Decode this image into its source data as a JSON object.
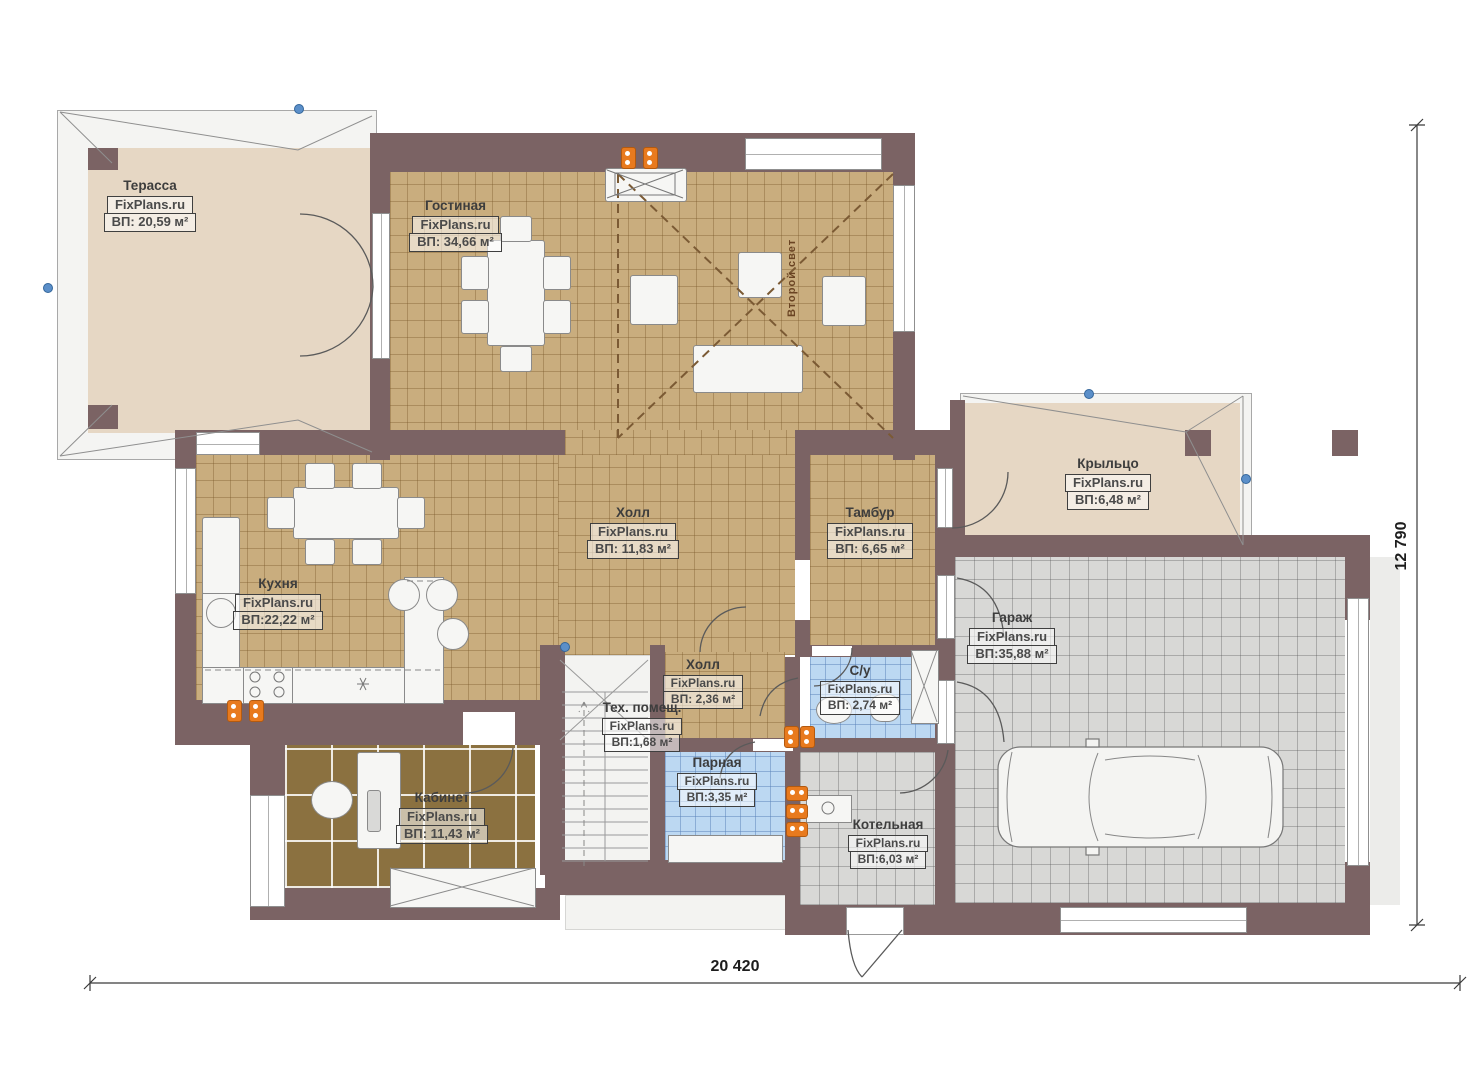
{
  "plan": {
    "watermark": "FixPlans.ru",
    "rooms": {
      "terrace": {
        "name": "Терасса",
        "area": "ВП: 20,59 м²"
      },
      "living": {
        "name": "Гостиная",
        "area": "ВП: 34,66 м²"
      },
      "kitchen": {
        "name": "Кухня",
        "area": "ВП:22,22 м²"
      },
      "hall": {
        "name": "Холл",
        "area": "ВП: 11,83 м²"
      },
      "tambour": {
        "name": "Тамбур",
        "area": "ВП: 6,65 м²"
      },
      "porch": {
        "name": "Крыльцо",
        "area": "ВП:6,48 м²"
      },
      "garage": {
        "name": "Гараж",
        "area": "ВП:35,88 м²"
      },
      "hall2": {
        "name": "Холл",
        "area": "ВП: 2,36 м²"
      },
      "wc": {
        "name": "С/у",
        "area": "ВП: 2,74 м²"
      },
      "tech": {
        "name": "Тех. помещ.",
        "area": "ВП:1,68 м²"
      },
      "steam": {
        "name": "Парная",
        "area": "ВП:3,35 м²"
      },
      "office": {
        "name": "Кабинет",
        "area": "ВП: 11,43 м²"
      },
      "boiler": {
        "name": "Котельная",
        "area": "ВП:6,03 м²"
      }
    },
    "annotations": {
      "second_light": "Второй свет"
    },
    "dimensions": {
      "width": "20 420",
      "height": "12 790"
    },
    "colors": {
      "wall": "#7b6364",
      "tile_tan": "#c9ad7e",
      "tile_gray": "#d8d8d6",
      "tile_blue": "#bcd8f2",
      "wood": "#8b7140",
      "terrace": "#e6d7c4",
      "radiator": "#e87a1e"
    }
  }
}
